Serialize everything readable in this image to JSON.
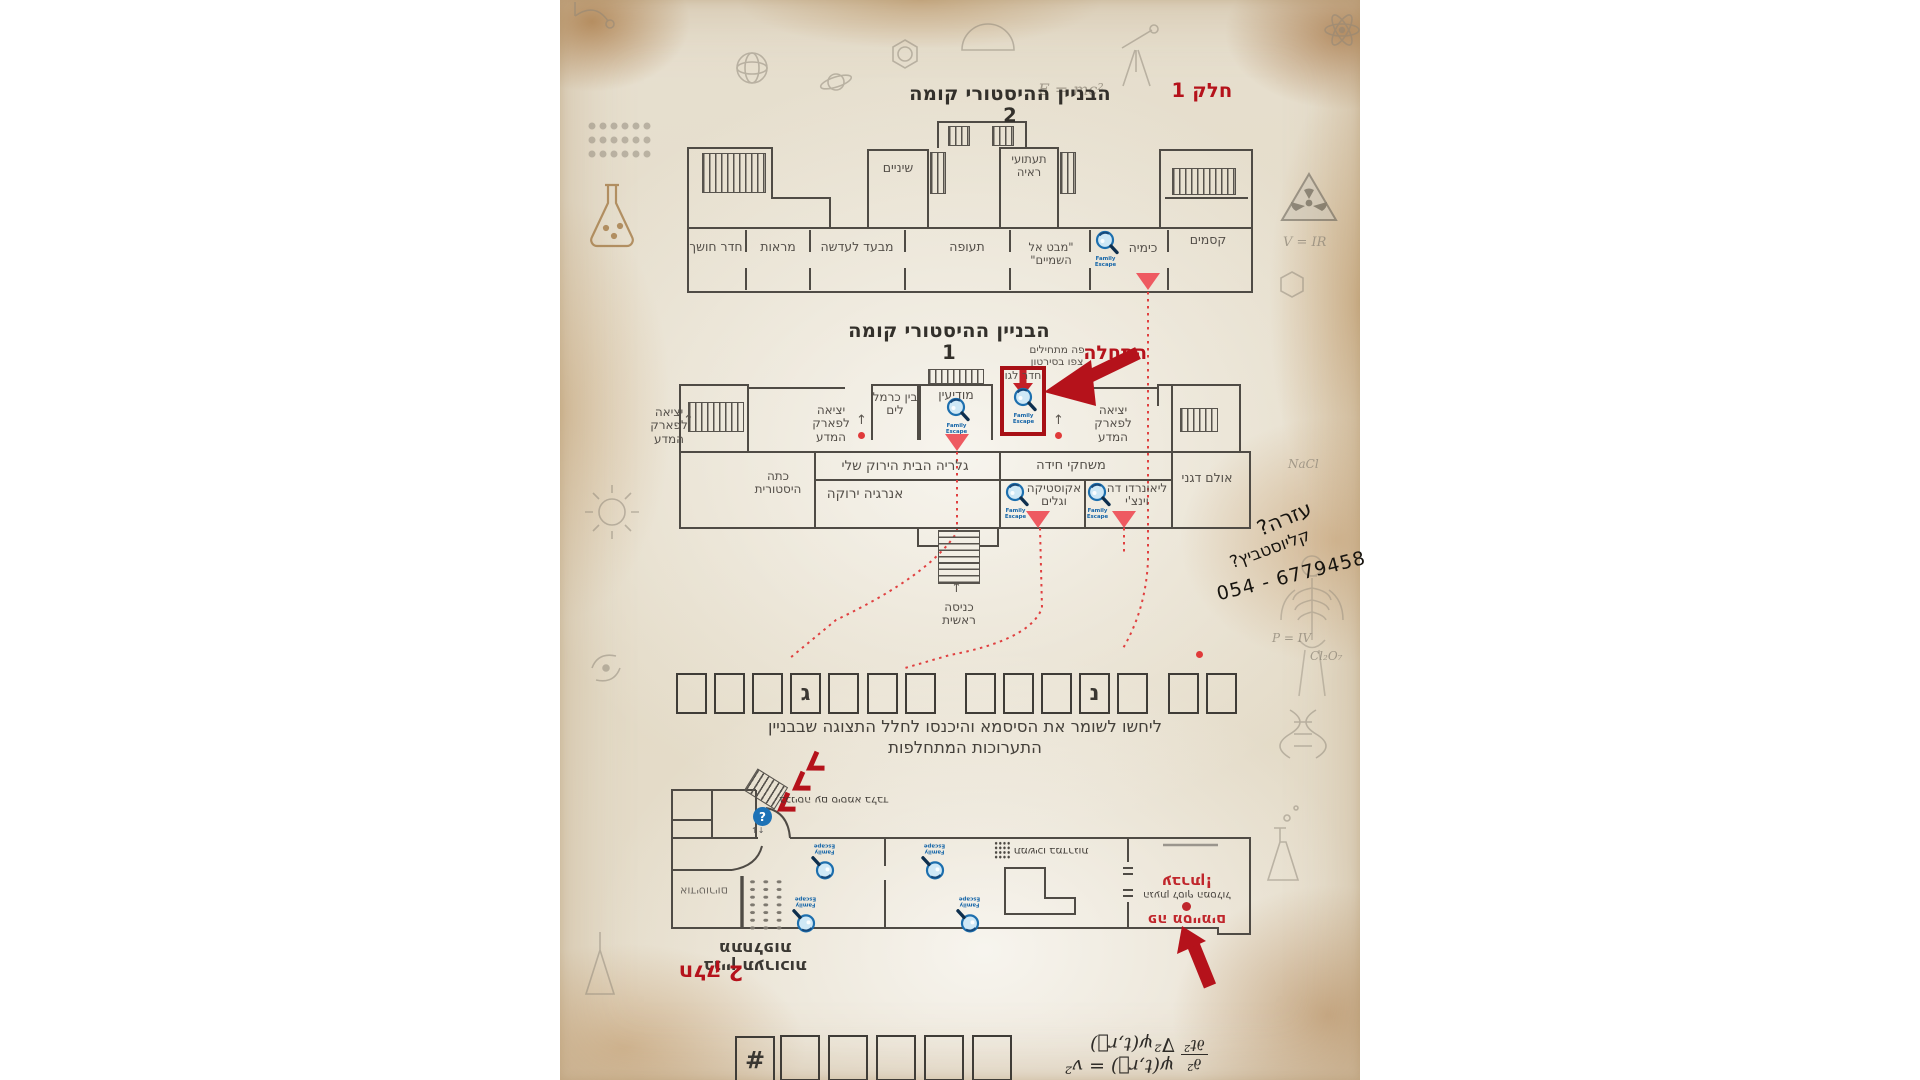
{
  "part1": "חלק 1",
  "part2": "חלק 2",
  "floor2": {
    "title": "הבניין ההיסטורי קומה 2",
    "rooms": {
      "dark_room": "חדר חושך",
      "mirrors": "מראות",
      "through_lens": "מבעד לעדשה",
      "aviation": "תעופה",
      "sky_view": "\"מבט אל השמיים\"",
      "chemistry": "כימיה",
      "magic": "קסמים",
      "teeth": "שיניים",
      "illusions": "תעתועי ראיה"
    }
  },
  "floor1": {
    "title": "הבניין ההיסטורי קומה 1",
    "start_label": "התחלה",
    "start_hint": "פה מתחילים צפו בסירטון",
    "rooms": {
      "lego": "חדר לגו",
      "carmel": "בין כרמל לים",
      "info": "מודיעין",
      "exit": "יציאה לפארק המדע",
      "green_house": "גלריה הבית הירוק שלי",
      "green_energy": "אנרגיה ירוקה",
      "historic_class": "כתה היסטורית",
      "puzzle_games": "משחקי חידה",
      "acoustics": "אקוסטיקה וגלים",
      "leonardo": "ליאונרדו דה וינצ'י",
      "degani_hall": "אולם דגני",
      "main_entrance": "כניסה ראשית"
    }
  },
  "password": {
    "letters": [
      "",
      "",
      "",
      "ג",
      "",
      "",
      "",
      "",
      "",
      "",
      "נ",
      "",
      "",
      ""
    ],
    "instruction": "ליחשו לשומר את הסיסמא והיכנסו לחלל התצוגה שבבניין התערוכות המתחלפות"
  },
  "handwriting": {
    "line1": "עזרה?",
    "line2": "קליוסטביץ?",
    "phone": "054 - 6779458"
  },
  "exhibitions": {
    "title": "בניין תערוכות מתחלפות",
    "entry_note": "בכניסה עם סיסמא בלבד",
    "auditorium": "אודיטוריום",
    "stairs_note": "תמשיכו במדרגות",
    "finish_excl": "עברתן!",
    "finish_line": "הגעתן לסוף המסלול",
    "finish_here": "פה מסיימים"
  },
  "formula": {
    "hash": "#",
    "lhs_top": "∂²",
    "lhs_bottom": "∂t²",
    "rhs": "ψ(t,r⃗) = v² ∇²ψ(t,r⃗)"
  },
  "logo": {
    "label": "Family Escape"
  },
  "icons": {
    "up": "↑",
    "updown": "↑↓",
    "info": "?"
  },
  "doodles": {
    "emc": "E = mc²",
    "vir": "V = IR",
    "nacl": "NaCl",
    "cl2o7": "Cl₂O₇",
    "piv": "P = IV"
  },
  "colors": {
    "accent_red": "#b5121b",
    "pin_red": "#ee5a61",
    "logo_blue": "#1d6fae"
  }
}
